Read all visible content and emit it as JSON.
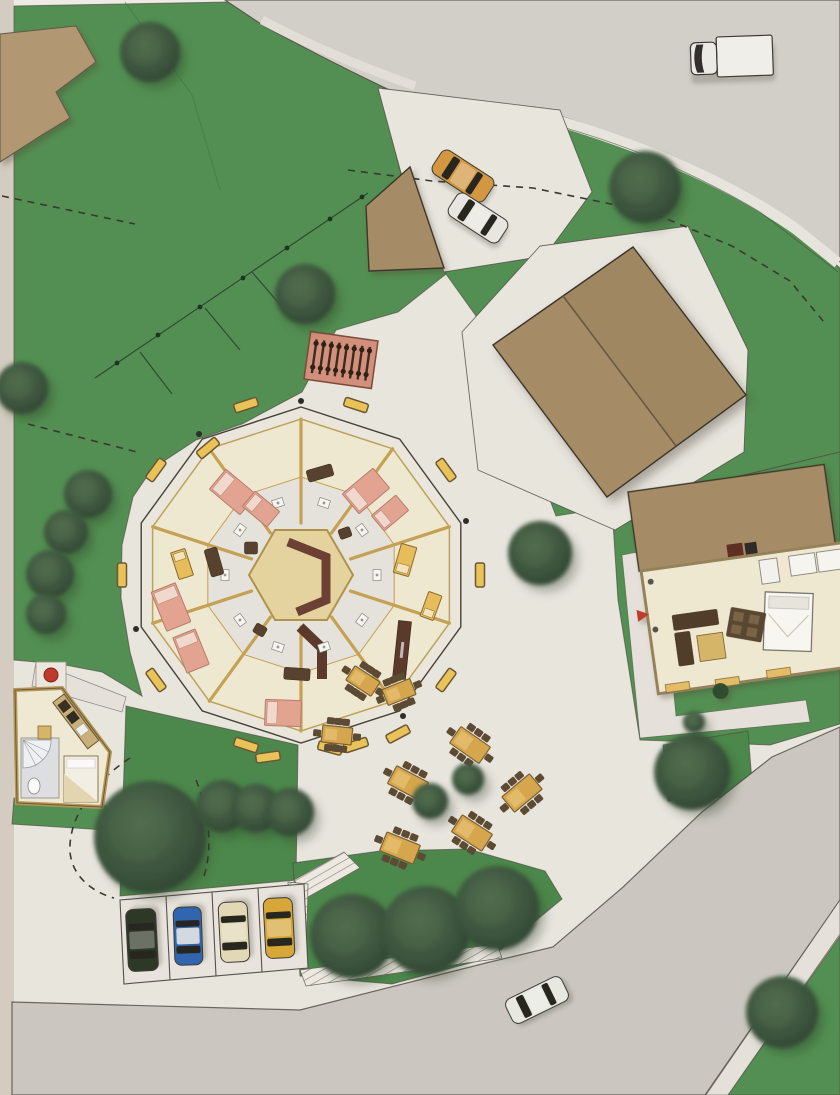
{
  "document": {
    "kind": "architectural-site-plan",
    "view": "top-down hand-colored rendering",
    "visible_text": []
  },
  "palette": {
    "paper": "#edebe4",
    "photo_edge": "#d8d1c5",
    "lawn": "#529253",
    "lawn2": "#4b8a4c",
    "road": "#d6d3ce",
    "road2": "#cfccc5",
    "sidewalk": "#eae7e0",
    "edge": "#4e4a42",
    "tan": "#b49b74",
    "barn": "#a78f68",
    "cream": "#f4eed6",
    "wall_gold": "#c9a455",
    "hex_core": "#e9d8a2",
    "maroon": "#6d4034",
    "chocolate": "#5b3a2b",
    "bed_pink": "#e7a695",
    "bed_pillow": "#f6ddd2",
    "bed_gold": "#ecc05c",
    "bench_yellow": "#eec75a",
    "table_gold": "#d9a94e",
    "chair_brown": "#5c4a33",
    "tree_dark": "#2f4734",
    "tree_mid": "#3f5a42",
    "bike_rack": "#d6927f",
    "red_accent": "#c23a2c"
  },
  "round_building": {
    "sides": 10,
    "center": {
      "x": 301,
      "y": 575
    },
    "outer_radius": 168,
    "ring_radius": 156,
    "corridor_radius": 98,
    "core_sides": 6,
    "core_radius": 52,
    "radial_walls": 10,
    "furniture": [
      [
        233,
        492,
        40,
        26,
        40,
        "bed-pink"
      ],
      [
        261,
        509,
        32,
        20,
        40,
        "bed-pink"
      ],
      [
        366,
        491,
        40,
        26,
        -40,
        "bed-pink"
      ],
      [
        390,
        513,
        32,
        20,
        -40,
        "bed-pink"
      ],
      [
        171,
        607,
        42,
        26,
        68,
        "bed-pink"
      ],
      [
        191,
        651,
        38,
        24,
        68,
        "bed-pink"
      ],
      [
        283,
        713,
        36,
        26,
        2,
        "bed-pink"
      ],
      [
        405,
        560,
        30,
        16,
        -74,
        "bed-gold"
      ],
      [
        431,
        606,
        26,
        14,
        -70,
        "bed-gold"
      ],
      [
        182,
        564,
        28,
        15,
        72,
        "bed-gold"
      ],
      [
        320,
        473,
        26,
        12,
        -16,
        "sofa"
      ],
      [
        214,
        562,
        28,
        13,
        74,
        "sofa"
      ],
      [
        297,
        674,
        26,
        12,
        4,
        "sofa"
      ],
      [
        251,
        548,
        13,
        12,
        0,
        "sofa"
      ],
      [
        345,
        533,
        12,
        10,
        -20,
        "sofa"
      ],
      [
        260,
        630,
        12,
        10,
        30,
        "sofa"
      ],
      [
        402,
        650,
        13,
        58,
        6,
        "bar"
      ]
    ],
    "corridor_fixtures": [
      [
        324,
        503,
        -72
      ],
      [
        362,
        530,
        -36
      ],
      [
        377,
        575,
        0
      ],
      [
        362,
        620,
        36
      ],
      [
        324,
        647,
        72
      ],
      [
        278,
        647,
        108
      ],
      [
        240,
        620,
        144
      ],
      [
        225,
        575,
        180
      ],
      [
        240,
        530,
        216
      ],
      [
        278,
        503,
        252
      ]
    ],
    "perimeter_benches": [
      [
        356,
        405,
        18
      ],
      [
        446,
        470,
        54
      ],
      [
        480,
        575,
        90
      ],
      [
        446,
        680,
        126
      ],
      [
        356,
        745,
        162
      ],
      [
        246,
        745,
        198
      ],
      [
        156,
        680,
        234
      ],
      [
        122,
        575,
        90
      ],
      [
        156,
        470,
        306
      ],
      [
        246,
        405,
        342
      ],
      [
        330,
        748,
        15
      ],
      [
        398,
        734,
        -28
      ],
      [
        268,
        757,
        -8
      ],
      [
        208,
        448,
        -40
      ]
    ],
    "entry_posts": [
      [
        301,
        401
      ],
      [
        466,
        521
      ],
      [
        403,
        716
      ],
      [
        136,
        629
      ],
      [
        199,
        434
      ]
    ]
  },
  "site": {
    "trees": [
      [
        150,
        52,
        30
      ],
      [
        645,
        187,
        36
      ],
      [
        305,
        294,
        30
      ],
      [
        22,
        388,
        26
      ],
      [
        88,
        494,
        24
      ],
      [
        66,
        532,
        22
      ],
      [
        50,
        574,
        24
      ],
      [
        46,
        614,
        20
      ],
      [
        540,
        553,
        32
      ],
      [
        150,
        837,
        56
      ],
      [
        222,
        806,
        26
      ],
      [
        256,
        808,
        24
      ],
      [
        290,
        812,
        24
      ],
      [
        352,
        936,
        42
      ],
      [
        426,
        930,
        44
      ],
      [
        497,
        908,
        42
      ],
      [
        692,
        772,
        38
      ],
      [
        782,
        1012,
        36
      ]
    ],
    "bushes": [
      [
        694,
        722,
        11
      ],
      [
        468,
        779,
        16
      ],
      [
        430,
        801,
        18
      ]
    ],
    "picnic_tables": [
      [
        470,
        745,
        35,
        36,
        20
      ],
      [
        408,
        783,
        28,
        36,
        20
      ],
      [
        522,
        793,
        -40,
        36,
        20
      ],
      [
        472,
        833,
        33,
        36,
        20
      ],
      [
        400,
        848,
        22,
        36,
        20
      ],
      [
        363,
        681,
        33,
        30,
        17
      ],
      [
        399,
        692,
        -22,
        30,
        17
      ],
      [
        337,
        735,
        6,
        30,
        17
      ]
    ],
    "cars": [
      {
        "color": "orange",
        "hex": "#d79a42",
        "x": 463,
        "y": 176,
        "rot": 33,
        "len": 62,
        "wid": 28
      },
      {
        "color": "white",
        "hex": "#ecece7",
        "x": 478,
        "y": 218,
        "rot": 33,
        "len": 60,
        "wid": 27
      },
      {
        "color": "dark-green",
        "hex": "#2b3926",
        "x": 142,
        "y": 940,
        "rot": -93,
        "len": 62,
        "wid": 30
      },
      {
        "color": "blue",
        "hex": "#2f66b5",
        "x": 188,
        "y": 936,
        "rot": -92,
        "len": 58,
        "wid": 28
      },
      {
        "color": "cream",
        "hex": "#e8ddbb",
        "x": 234,
        "y": 932,
        "rot": -93,
        "len": 60,
        "wid": 29
      },
      {
        "color": "yellow",
        "hex": "#dcab3b",
        "x": 279,
        "y": 928,
        "rot": -93,
        "len": 60,
        "wid": 29
      },
      {
        "color": "white-sedan",
        "hex": "#edeee9",
        "x": 537,
        "y": 1000,
        "rot": -26,
        "len": 62,
        "wid": 27
      }
    ],
    "truck": {
      "color": "white",
      "x": 688,
      "y": 36,
      "rot": -2
    },
    "parking": {
      "stall_count": 4
    },
    "bike_rack": {
      "x": 341,
      "y": 360,
      "rot": 8,
      "bikes": 8
    }
  }
}
